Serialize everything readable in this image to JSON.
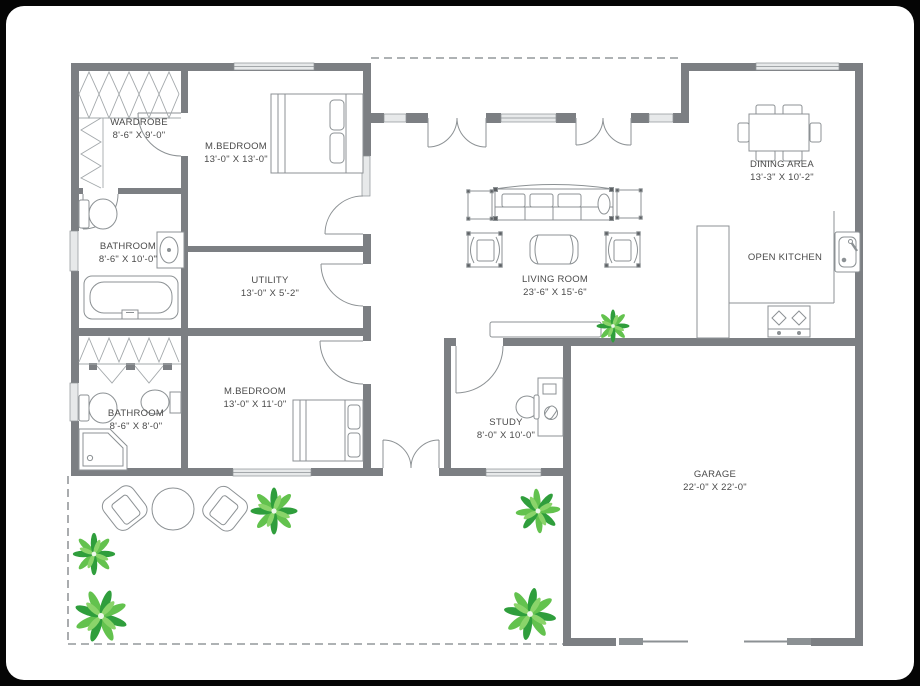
{
  "rooms": {
    "wardrobe": {
      "name": "WARDROBE",
      "dims": "8'-6\" X 9'-0\""
    },
    "master_bedroom_top": {
      "name": "M.BEDROOM",
      "dims": "13'-0\" X 13'-0\""
    },
    "bathroom_top": {
      "name": "BATHROOM",
      "dims": "8'-6\" X 10'-0\""
    },
    "utility": {
      "name": "UTILITY",
      "dims": "13'-0\" X 5'-2\""
    },
    "bathroom_bottom": {
      "name": "BATHROOM",
      "dims": "8'-6\" X 8'-0\""
    },
    "master_bedroom_bottom": {
      "name": "M.BEDROOM",
      "dims": "13'-0\" X 11'-0\""
    },
    "living_room": {
      "name": "LIVING ROOM",
      "dims": "23'-6\" X 15'-6\""
    },
    "dining_area": {
      "name": "DINING AREA",
      "dims": "13'-3\" X 10'-2\""
    },
    "open_kitchen": {
      "name": "OPEN KITCHEN",
      "dims": ""
    },
    "study": {
      "name": "STUDY",
      "dims": "8'-0\" X 10'-0\""
    },
    "garage": {
      "name": "GARAGE",
      "dims": "22'-0\" X 22'-0\""
    }
  },
  "colors": {
    "wall": "#7c7f83",
    "furniture_line": "#8c9194",
    "window_fill": "#e7e9ea",
    "plant_dark": "#2f9e3c",
    "plant_light": "#63c24e",
    "label_text": "#4a4a4a",
    "card": "#ffffff",
    "background": "#050505"
  }
}
